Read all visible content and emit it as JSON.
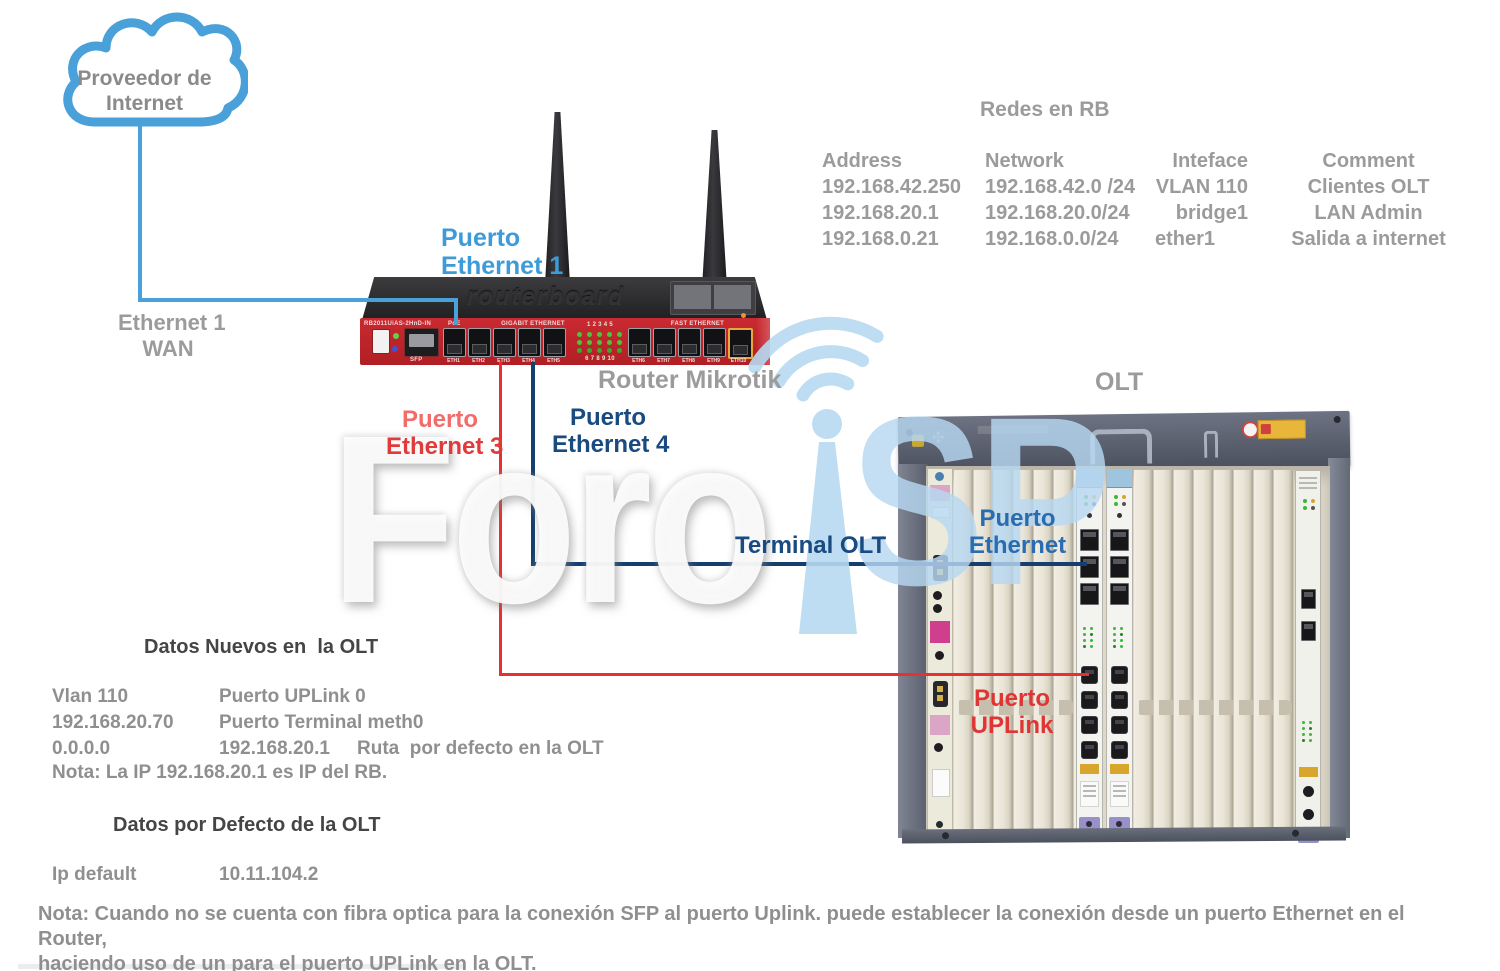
{
  "cloud": {
    "line1": "Proveedor de",
    "line2": "Internet"
  },
  "wan_label": {
    "line1": "Ethernet 1",
    "line2": "WAN"
  },
  "router": {
    "name": "Router Mikrotik",
    "model": "RB2011UiAS-2HnD-IN",
    "brand": "routerboard",
    "sfp": "SFP",
    "poe": "PoE",
    "gigabit_section": "GIGABIT ETHERNET",
    "fast_section": "FAST ETHERNET",
    "led_numbers_top": "1 2 3 4 5",
    "led_numbers_bottom": "6 7 8 9 10",
    "ports_gigabit": [
      "ETH1",
      "ETH2",
      "ETH3",
      "ETH4",
      "ETH5"
    ],
    "ports_fast": [
      "ETH6",
      "ETH7",
      "ETH8",
      "ETH9",
      "ETH10"
    ]
  },
  "labels": {
    "puerto_eth1_l1": "Puerto",
    "puerto_eth1_l2": "Ethernet 1",
    "puerto_eth3_l1": "Puerto",
    "puerto_eth3_l2": "Ethernet 3",
    "puerto_eth4_l1": "Puerto",
    "puerto_eth4_l2": "Ethernet 4",
    "terminal_olt": "Terminal OLT",
    "olt": "OLT",
    "puerto_ethernet_l1": "Puerto",
    "puerto_ethernet_l2": "Ethernet",
    "puerto_uplink_l1": "Puerto",
    "puerto_uplink_l2": "UPLink"
  },
  "rb_table": {
    "title": "Redes en RB",
    "headers": [
      "Address",
      "Network",
      "Inteface",
      "Comment"
    ],
    "rows": [
      [
        "192.168.42.250",
        "192.168.42.0 /24",
        "VLAN 110",
        "Clientes OLT"
      ],
      [
        "192.168.20.1",
        "192.168.20.0/24",
        "bridge1",
        "LAN Admin"
      ],
      [
        "192.168.0.21",
        "192.168.0.0/24",
        "ether1",
        "Salida a internet"
      ]
    ]
  },
  "datos_nuevos": {
    "title": "Datos Nuevos en  la OLT",
    "rows": [
      [
        "Vlan 110",
        "Puerto UPLink 0",
        ""
      ],
      [
        "192.168.20.70",
        "Puerto Terminal meth0",
        ""
      ],
      [
        "0.0.0.0",
        "192.168.20.1",
        "Ruta  por defecto en la OLT"
      ]
    ],
    "nota": "Nota: La IP 192.168.20.1 es IP del RB."
  },
  "datos_defecto": {
    "title": "Datos por Defecto de la OLT",
    "key": "Ip default",
    "value": "10.11.104.2"
  },
  "nota_bottom": {
    "line1": "Nota: Cuando no se cuenta con fibra optica para la conexión SFP al puerto Uplink. puede establecer la conexión desde un puerto Ethernet en el Router,",
    "line2": "haciendo uso de un para el puerto UPLink en la OLT."
  },
  "watermark": {
    "part1": "Foro",
    "part2": "SP"
  },
  "colors": {
    "line_light_blue": "#4aa0d8",
    "line_red": "#e83030",
    "line_navy": "#163e6e",
    "label_light_blue": "#3d9bd9",
    "label_navy": "#194a80",
    "label_medium_blue": "#2a6cb0",
    "label_red": "#e03a3a",
    "label_red_light": "#f26c6c",
    "gray_text": "#9b9b9b",
    "dark_text": "#454545",
    "router_red": "#c92a30",
    "watermark_blue": "#b7d9f1"
  }
}
